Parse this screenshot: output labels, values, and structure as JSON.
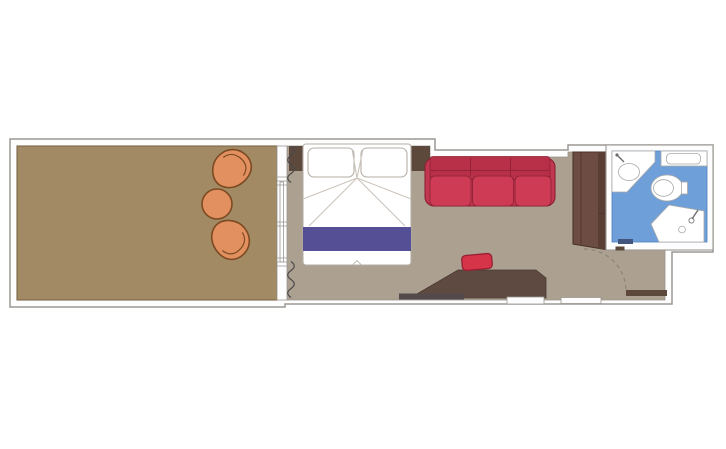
{
  "floorplan": {
    "type": "cruise-ship-cabin-floor-plan",
    "orientation": "horizontal",
    "rooms": [
      {
        "name": "balcony",
        "floor_color_ref": "balcony_floor",
        "furniture": [
          "lounge-chair",
          "round-table",
          "lounge-chair"
        ]
      },
      {
        "name": "cabin",
        "floor_color_ref": "cabin_floor",
        "furniture": [
          "headboard",
          "double-bed",
          "pillow",
          "pillow",
          "bed-runner",
          "sofa",
          "wardrobe",
          "desk",
          "stool",
          "shelf-bar"
        ]
      },
      {
        "name": "bathroom",
        "floor_color_ref": "bath_floor",
        "furniture": [
          "sink",
          "counter",
          "toilet",
          "shower"
        ]
      },
      {
        "name": "entry",
        "floor_color_ref": "cabin_floor",
        "furniture": [
          "entry-door",
          "door-swing-arc"
        ]
      }
    ],
    "features": [
      "sliding-glass-door",
      "curtains",
      "wall-openings"
    ]
  },
  "colors": {
    "page_bg": "#ffffff",
    "wall_fill": "#fdfdfd",
    "wall_line": "#9b9893",
    "balcony_floor": "#a18a64",
    "balcony_floor_line": "#7c6747",
    "cabin_floor": "#aca091",
    "cabin_floor_line": "#98928b",
    "wood_dark": "#5d493c",
    "wardrobe": "#6d4c43",
    "wardrobe_dark": "#5a3e35",
    "wardrobe_line": "#4a332c",
    "desk": "#5f4a41",
    "desk_line": "#4a3a33",
    "shelf_bar": "#544a4b",
    "bed_fill": "#ffffff",
    "bed_line": "#b5aea6",
    "crease_line": "#ccc5bd",
    "runner": "#555096",
    "sofa_base": "#c13750",
    "sofa_back": "#b82f48",
    "sofa_cushion": "#cd3b55",
    "sofa_line": "#8c2135",
    "stool": "#d63549",
    "stool_line": "#971f33",
    "chair": "#e2905f",
    "chair_line": "#7d4a22",
    "bath_floor": "#6f9fd9",
    "bath_floor_line": "#4c7fbe",
    "fixture_fill": "#ffffff",
    "fixture_line": "#a9a9a9",
    "fixture_icon": "#6e6e6e",
    "curtain": "#4a4a4a",
    "swing_arc": "#8d8278",
    "door_dash": "#41557e"
  }
}
